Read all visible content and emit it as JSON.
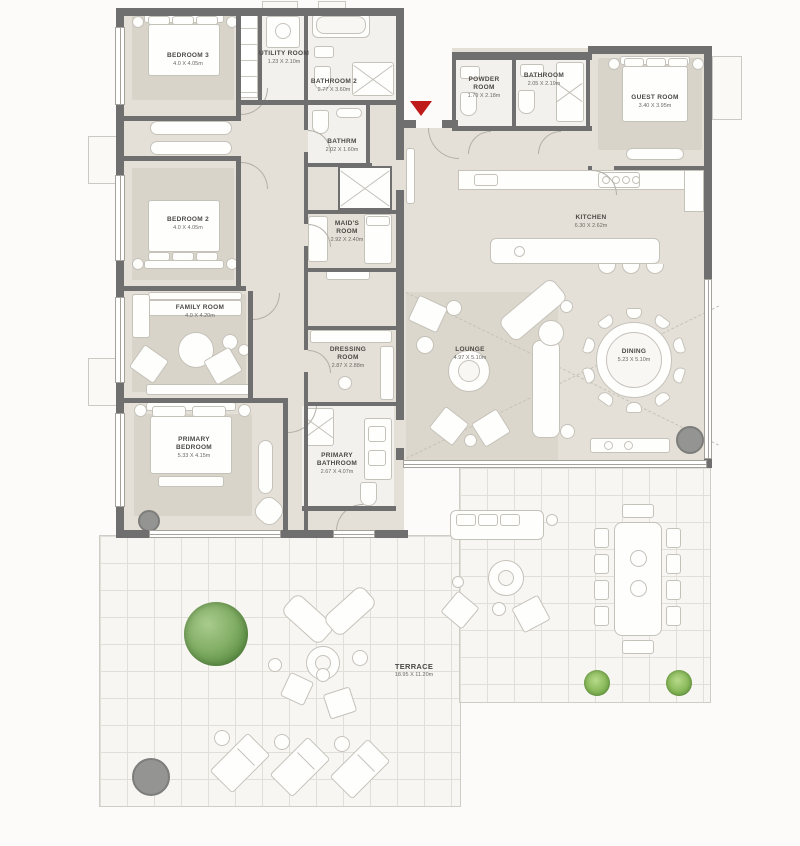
{
  "rooms": {
    "bedroom3": {
      "name": "BEDROOM 3",
      "dims": "4.0 X 4.05m"
    },
    "utility": {
      "name": "UTILITY ROOM",
      "dims": "1.23 X 2.10m"
    },
    "bathroom2": {
      "name": "BATHROOM 2",
      "dims": "2.77 X 3.60m"
    },
    "bathrm": {
      "name": "BATHRM",
      "dims": "2.02 X 1.60m"
    },
    "maids": {
      "name": "MAID'S ROOM",
      "dims": "2.92 X 2.40m"
    },
    "bedroom2": {
      "name": "BEDROOM 2",
      "dims": "4.0 X 4.05m"
    },
    "family": {
      "name": "FAMILY ROOM",
      "dims": "4.0 X 4.20m"
    },
    "primary_bedroom": {
      "name": "PRIMARY BEDROOM",
      "dims": "5.33 X 4.15m"
    },
    "dressing": {
      "name": "DRESSING ROOM",
      "dims": "2.87 X 2.88m"
    },
    "primary_bathroom": {
      "name": "PRIMARY BATHROOM",
      "dims": "2.67 X 4.07m"
    },
    "powder": {
      "name": "POWDER ROOM",
      "dims": "1.70 X 2.18m"
    },
    "bathroom": {
      "name": "BATHROOM",
      "dims": "2.05 X 2.19m"
    },
    "guest": {
      "name": "GUEST ROOM",
      "dims": "3.40 X 3.95m"
    },
    "kitchen": {
      "name": "KITCHEN",
      "dims": "6.30 X 2.62m"
    },
    "lounge": {
      "name": "LOUNGE",
      "dims": "4.97 X 5.10m"
    },
    "dining": {
      "name": "DINING",
      "dims": "5.23 X 5.10m"
    },
    "terrace": {
      "name": "TERRACE",
      "dims": "18.95 X 11.20m"
    }
  },
  "colors": {
    "wall": "#6f6f6f",
    "floor": "#e4e0d8",
    "wet_floor": "#f3f1ed",
    "terrace": "#f7f6f2",
    "entry_marker": "#c01b1b",
    "tree": "#5f9247"
  }
}
